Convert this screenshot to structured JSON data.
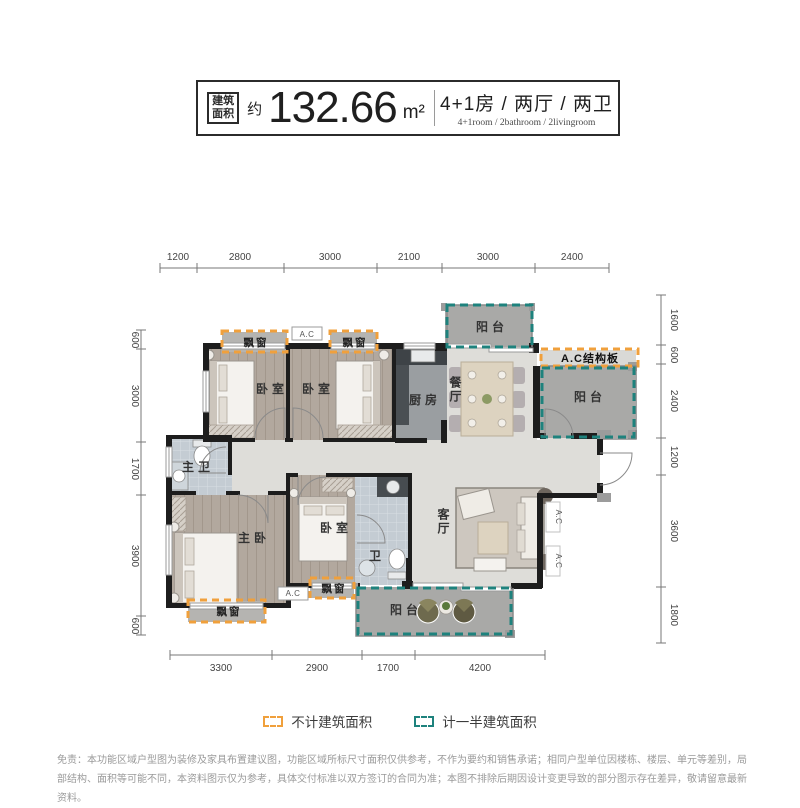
{
  "header": {
    "area_tag_line1": "建筑",
    "area_tag_line2": "面积",
    "approx": "约",
    "area_value": "132.66",
    "area_unit": "m²",
    "rooms_cn": "4+1房 / 两厅 / 两卫",
    "rooms_en": "4+1room / 2bathroom / 2livingroom"
  },
  "dims": {
    "top": [
      "1200",
      "2800",
      "3000",
      "2100",
      "3000",
      "2400"
    ],
    "bottom": [
      "3300",
      "2900",
      "1700",
      "4200"
    ],
    "left": [
      "600",
      "3000",
      "1700",
      "3900",
      "600"
    ],
    "right": [
      "1600",
      "600",
      "2400",
      "1200",
      "3600",
      "1800"
    ]
  },
  "labels": {
    "bay_window": "飘窗",
    "ac": "A.C",
    "ac_board": "A.C结构板",
    "bedroom": "卧室",
    "balcony": "阳台",
    "kitchen": "厨房",
    "dining": "餐厅",
    "master_bath": "主卫",
    "master_bedroom": "主卧",
    "bath": "卫",
    "living": "客厅"
  },
  "legend": {
    "not_counted": "不计建筑面积",
    "half_counted": "计一半建筑面积"
  },
  "colors": {
    "orange": "#F0A03C",
    "teal": "#1E827D"
  },
  "disclaimer": "免责：本功能区域户型图为装修及家具布置建议图，功能区域所标尺寸面积仅供参考，不作为要约和销售承诺；相同户型单位因楼栋、楼层、单元等差别，局部结构、面积等可能不同，本资料图示仅为参考，具体交付标准以双方签订的合同为准；本图不排除后期因设计变更导致的部分图示存在差异，敬请留意最新资料。"
}
